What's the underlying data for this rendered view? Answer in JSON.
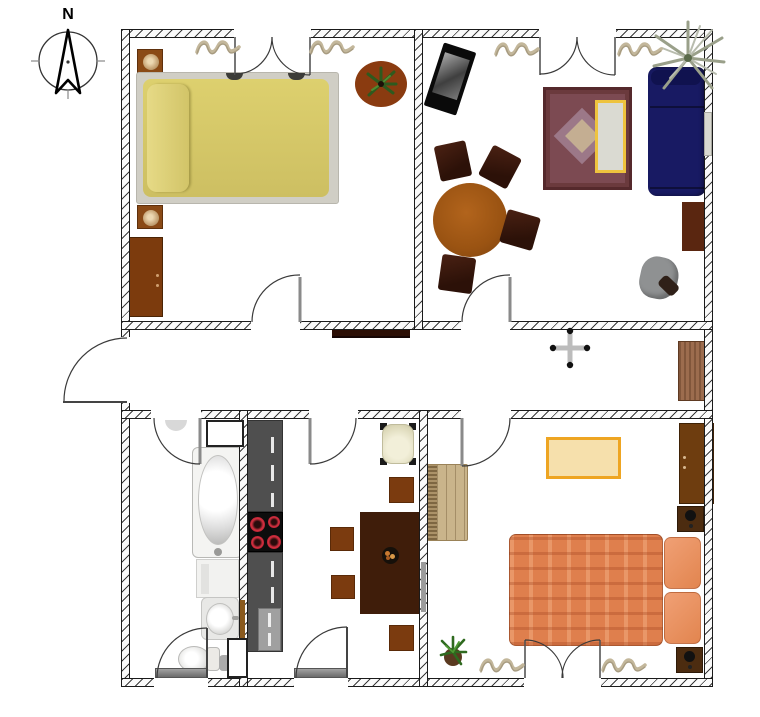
{
  "compass": {
    "north_label": "N"
  },
  "palette": {
    "wall_line": "#1a1a1a",
    "bed_yellow": "#d6c972",
    "bed_orange": "#df7f4d",
    "sofa_navy": "#181a63",
    "rug_red": "#6b3a3d",
    "rug_border_yellow": "#eec33e",
    "counter_gray": "#4f4f4f",
    "stove_black": "#0d0d0d",
    "burner_red": "#d63040",
    "wood_dark": "#3f1d0a",
    "wood_medium": "#7c3b0d",
    "wood_cabinet": "#9c6c4e",
    "chair_dark_brown": "#2c1108",
    "armchair_cream": "#e9e6cf",
    "fixture_white": "#f4f4f2"
  },
  "hallway": {
    "items": [
      "wall-shelf",
      "ceiling-light",
      "hall-cabinet",
      "entrance-door"
    ]
  },
  "rooms": [
    {
      "name": "bedroom-top-left",
      "furniture": [
        "nightstand-lamp",
        "double-bed-yellow",
        "potted-plant",
        "dresser",
        "nightstand-lamp",
        "radiator",
        "wall-clothes-decor",
        "double-door-top",
        "door-to-hallway"
      ]
    },
    {
      "name": "living-room-top-right",
      "furniture": [
        "tv",
        "oriental-rug",
        "coffee-table-yellow",
        "sofa-navy",
        "palm-plant",
        "round-dining-table",
        "chair",
        "chair",
        "chair",
        "chair",
        "side-table",
        "gray-swivel-chair",
        "window",
        "double-door-top",
        "door-to-hallway"
      ]
    },
    {
      "name": "bathroom-bottom-left",
      "furniture": [
        "bathtub",
        "washing-machine",
        "sink",
        "toilet",
        "pipe-shaft",
        "pipe-shaft",
        "door-to-hallway",
        "exterior-door"
      ]
    },
    {
      "name": "kitchen-bottom-middle",
      "furniture": [
        "counter-upper",
        "stove-4-burners",
        "counter-lower",
        "dishwasher-panel",
        "cream-armchair",
        "dining-table",
        "fruit-bowl",
        "chair",
        "chair",
        "chair",
        "door-to-hallway",
        "exterior-door"
      ]
    },
    {
      "name": "bedroom-bottom-right",
      "furniture": [
        "wicker-chest",
        "rug-yellow-border",
        "wardrobe",
        "nightstand-lamp",
        "double-bed-orange",
        "potted-plant",
        "nightstand-lamp",
        "mirror-strip",
        "wall-clothes-decor",
        "door-to-hallway",
        "double-door-bottom"
      ]
    }
  ]
}
